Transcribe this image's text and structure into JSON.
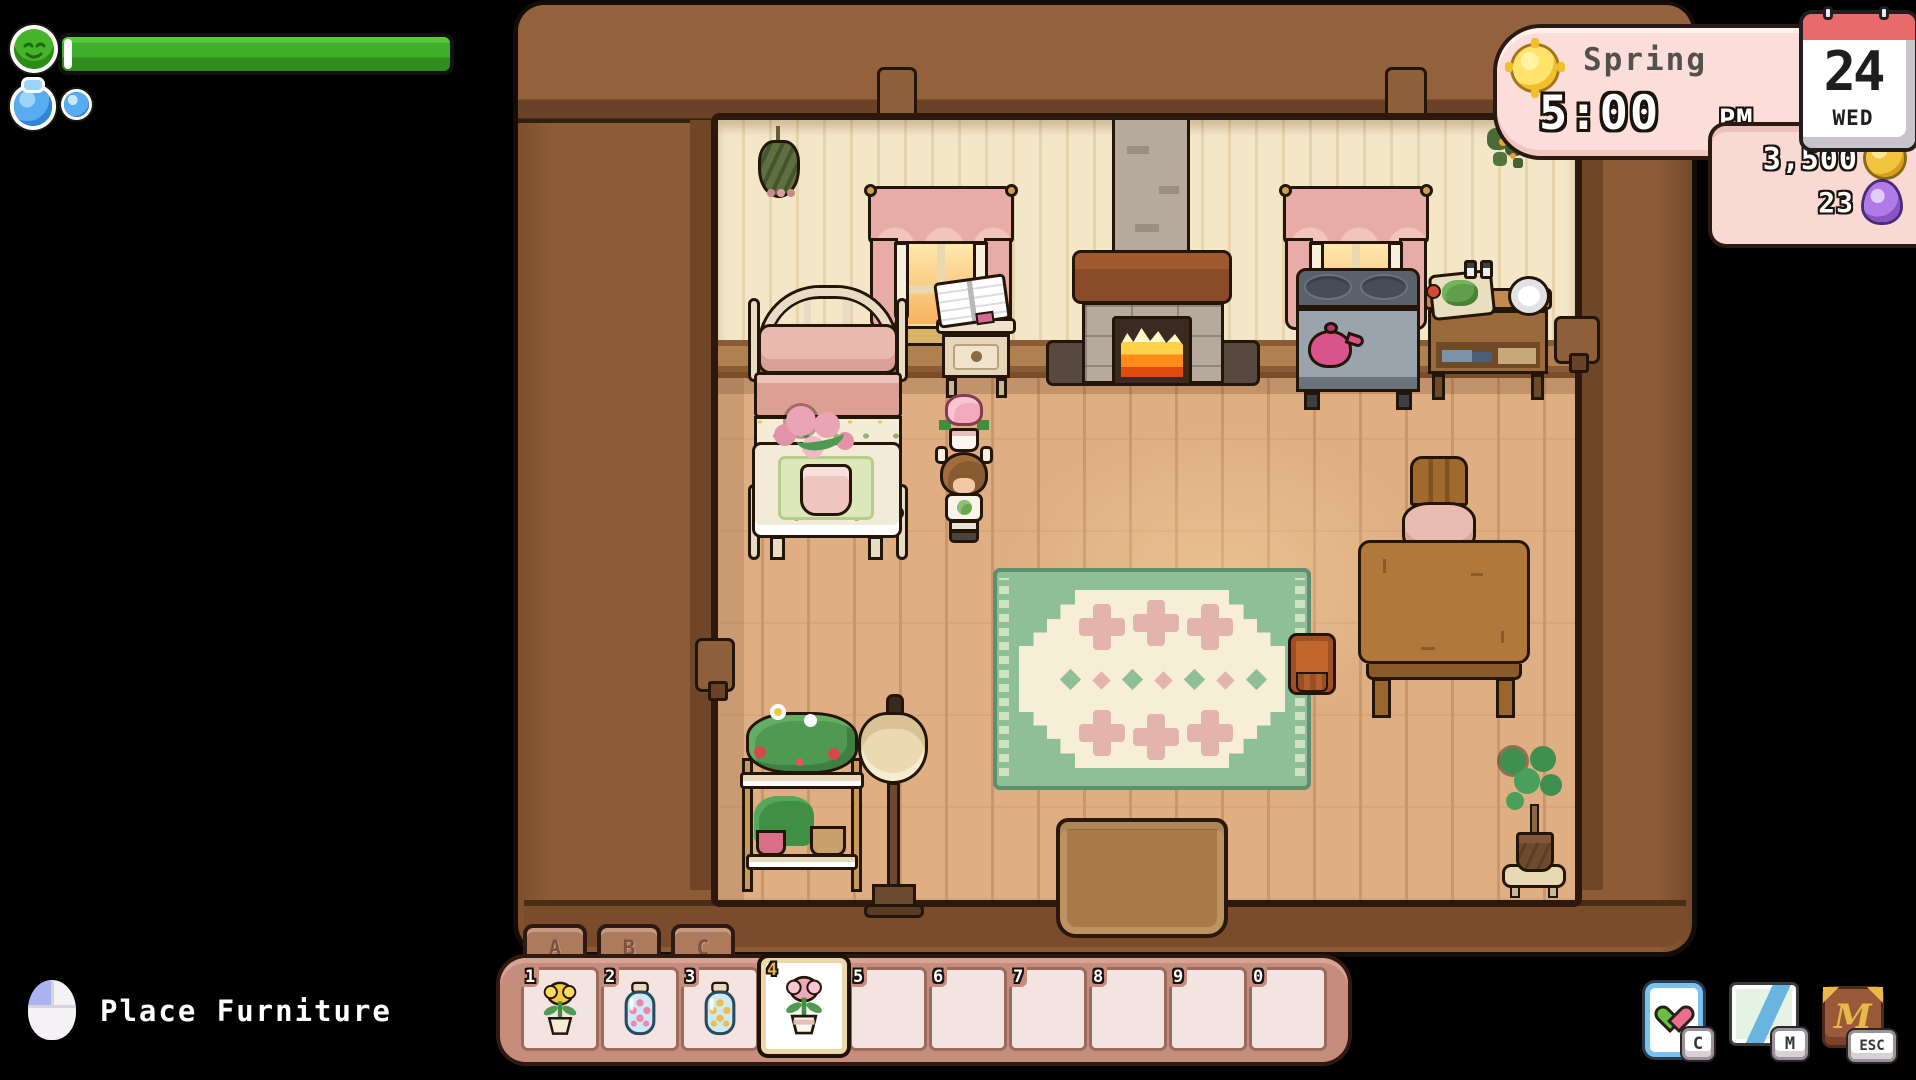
{
  "hud": {
    "season_panel": {
      "season": "Spring",
      "time": "5:00",
      "meridiem": "PM",
      "sun_icon": "sun-icon",
      "bg_color": "#fbdeda"
    },
    "calendar": {
      "day": "24",
      "weekday": "WED",
      "accent_color": "#e86a6a"
    },
    "currency": {
      "gold": "3,500",
      "gold_icon": "coin-icon",
      "essence": "23",
      "essence_icon": "essence-gem-icon",
      "bg_color": "#f8d9d4"
    },
    "health": {
      "icon": "health-smiley-icon",
      "fill_percent": 100,
      "bar_color": "#3fae2a"
    },
    "water": {
      "icon": "water-jug-icon",
      "orb_count": 1,
      "color": "#58acf2"
    },
    "action_hint": {
      "icon": "mouse-left-click-icon",
      "label": "Place Furniture"
    },
    "shortcuts": [
      {
        "icon": "relationships-heart-icon",
        "key": "C"
      },
      {
        "icon": "map-icon",
        "key": "M"
      },
      {
        "icon": "journal-book-icon",
        "key": "ESC"
      }
    ]
  },
  "hotbar": {
    "tabs": [
      {
        "label": "A"
      },
      {
        "label": "B"
      },
      {
        "label": "C"
      }
    ],
    "selected_slot_number": "4",
    "colors": {
      "bar": "#c68d7d",
      "slot": "#f3e4e2",
      "selected_border": "#eed7a8"
    },
    "slots": [
      {
        "number": "1",
        "item": "potted yellow tulip"
      },
      {
        "number": "2",
        "item": "jar of pink petals"
      },
      {
        "number": "3",
        "item": "jar of yellow petals"
      },
      {
        "number": "4",
        "item": "pink tulip"
      },
      {
        "number": "5",
        "item": ""
      },
      {
        "number": "6",
        "item": ""
      },
      {
        "number": "7",
        "item": ""
      },
      {
        "number": "8",
        "item": ""
      },
      {
        "number": "9",
        "item": ""
      },
      {
        "number": "0",
        "item": ""
      }
    ]
  },
  "scene": {
    "objects": [
      "hanging-herbs",
      "window",
      "fireplace",
      "stove",
      "kitchen-counter",
      "bed",
      "flower-table",
      "nightstand",
      "player-character",
      "plant-shelf",
      "floor-lamp",
      "rug",
      "small-stool",
      "dining-table",
      "chair",
      "potted-plant",
      "door-mat",
      "garland"
    ],
    "colors": {
      "frame": "#8d5c37",
      "wall": "#f4e7c8",
      "floor": "#dfae83",
      "rug_green": "#8fbf97",
      "rug_field": "#f7eed6"
    }
  }
}
